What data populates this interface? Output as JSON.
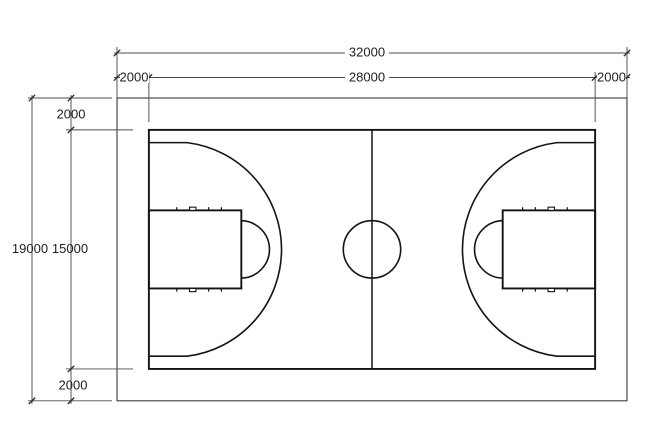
{
  "meta": {
    "kind": "technical-dimension-drawing",
    "subject": "basketball-court-plan"
  },
  "colors": {
    "background": "#ffffff",
    "court_line": "#141414",
    "boundary_line": "#3a3a3a",
    "dimension_line": "#4d4d4d",
    "arrow": "#262626",
    "label_text": "#1f1f1f"
  },
  "dimensions": {
    "overall_width": {
      "label": "32000",
      "value": 32000
    },
    "overall_height": {
      "label": "19000",
      "value": 19000
    },
    "court_width": {
      "label": "28000",
      "value": 28000
    },
    "court_height": {
      "label": "15000",
      "value": 15000
    },
    "margin_left": {
      "label": "2000",
      "value": 2000
    },
    "margin_right": {
      "label": "2000",
      "value": 2000
    },
    "margin_top": {
      "label": "2000",
      "value": 2000
    },
    "margin_bottom": {
      "label": "2000",
      "value": 2000
    }
  },
  "geometry": {
    "overall": {
      "width": 32000,
      "height": 19000
    },
    "court": {
      "width": 28000,
      "height": 15000
    },
    "margin": 2000,
    "key": {
      "length": 5800,
      "width": 4900
    },
    "free_throw_circle_radius": 1800,
    "center_circle_radius": 1800,
    "three_point_radius": 6750,
    "basket_offset_from_baseline": 1575,
    "three_point_side_offset": 800,
    "lane_tick_offsets": [
      1750,
      3750,
      4550
    ],
    "neutral_zone_center_offset": 2750,
    "neutral_zone_width": 400,
    "lane_tick_length": 200
  }
}
